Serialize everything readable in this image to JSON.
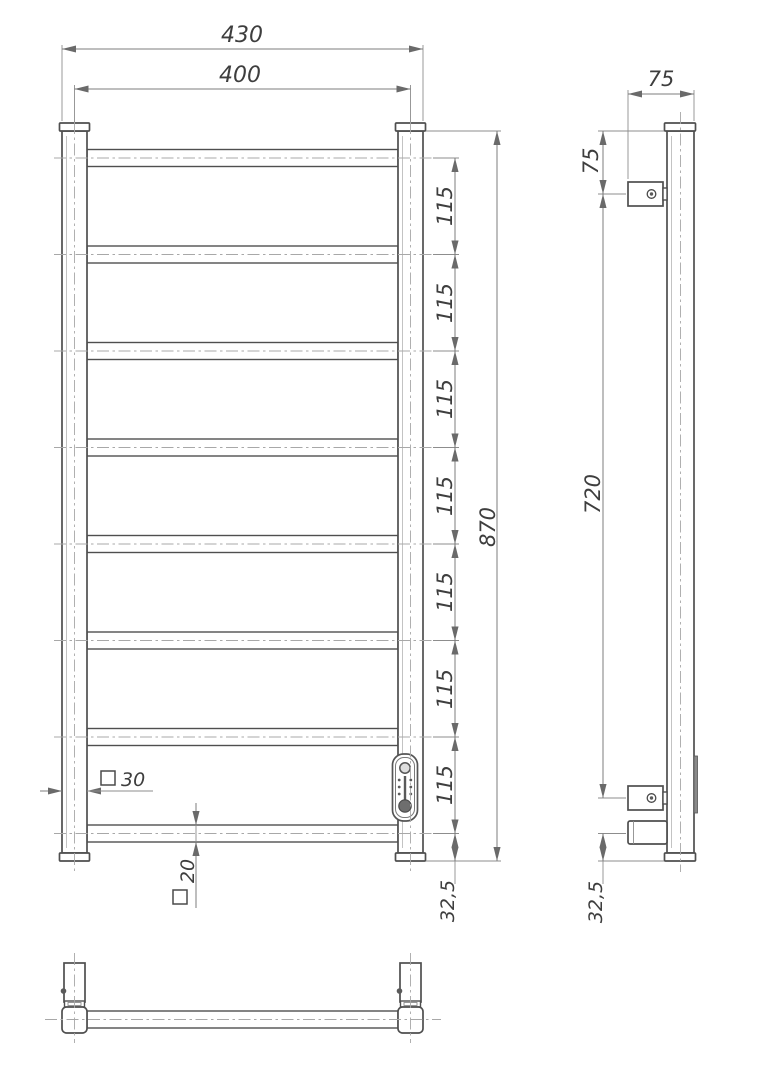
{
  "front_view": {
    "overall_width": "430",
    "mounting_width": "400",
    "overall_height": "870",
    "rung_spacing": "115",
    "bottom_rung_offset": "32,5",
    "post_profile": "30",
    "rung_profile": "20",
    "rung_count": 8
  },
  "side_view": {
    "depth": "75",
    "top_bracket_offset": "75",
    "bracket_spacing": "720",
    "bottom_offset": "32,5"
  },
  "symbols": {
    "square_profile": "square-section-symbol"
  },
  "colors": {
    "outline": "#4f4f4f",
    "dimension_line": "#7d7d7d",
    "centerline": "#a8a8a8",
    "text": "#3e3e3e",
    "background": "#ffffff"
  }
}
